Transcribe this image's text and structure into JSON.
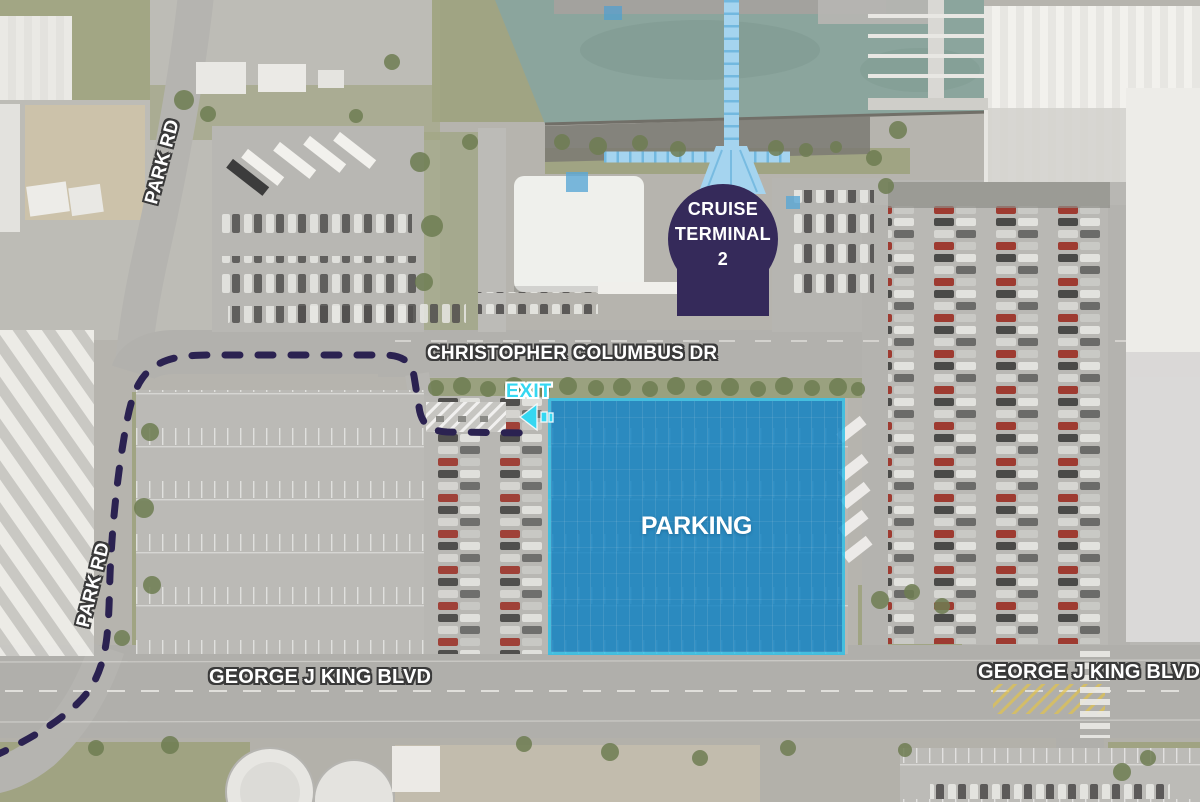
{
  "badge": {
    "line1": "CRUISE",
    "line2": "TERMINAL",
    "line3": "2"
  },
  "overlays": {
    "parking_label": "PARKING",
    "exit_label": "EXIT"
  },
  "streets": {
    "christopher_columbus_dr": "CHRISTOPHER COLUMBUS DR",
    "george_j_king_blvd_west": "GEORGE J KING BLVD",
    "george_j_king_blvd_east": "GEORGE J KING BLVD",
    "park_rd_north": "PARK RD",
    "park_rd_south": "PARK RD"
  },
  "icons": {
    "exit_arrow": "arrow-left"
  },
  "colors": {
    "terminal_badge": "#352a5a",
    "parking_overlay": "#0d81c2",
    "parking_border": "#2bc0e8",
    "route_dashed": "#2b2251",
    "exit_cyan": "#35d7f1",
    "water": "#8ba59d"
  }
}
